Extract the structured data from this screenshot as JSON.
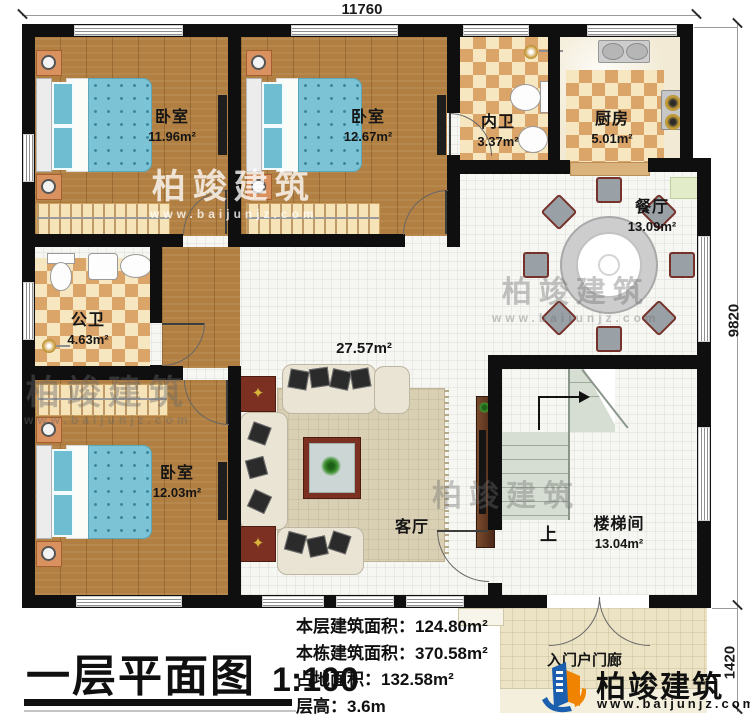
{
  "dimensions": {
    "top": "11760",
    "right_main": "9820",
    "right_porch": "1420"
  },
  "rooms": {
    "bedroom1": {
      "label": "卧室",
      "area": "11.96m²"
    },
    "bedroom2": {
      "label": "卧室",
      "area": "12.67m²"
    },
    "bedroom3": {
      "label": "卧室",
      "area": "12.03m²"
    },
    "inner_bath": {
      "label": "内卫",
      "area": "3.37m²"
    },
    "kitchen": {
      "label": "厨房",
      "area": "5.01m²"
    },
    "public_bath": {
      "label": "公卫",
      "area": "4.63m²"
    },
    "dining": {
      "label": "餐厅",
      "area": "13.09m²"
    },
    "living": {
      "label": "客厅",
      "area": "27.57m²"
    },
    "stairwell": {
      "label": "楼梯间",
      "area": "13.04m²",
      "up": "上"
    },
    "porch": {
      "label": "入门户门廊"
    }
  },
  "title_block": {
    "title": "一层平面图",
    "scale": "1:100"
  },
  "stats": {
    "floor_area": {
      "label": "本层建筑面积：",
      "value": "124.80m²"
    },
    "building_area": {
      "label": "本栋建筑面积：",
      "value": "370.58m²"
    },
    "footprint": {
      "label": "占地面积：",
      "value": "132.58m²"
    },
    "floor_height": {
      "label": "层高：",
      "value": "3.6m"
    }
  },
  "branding": {
    "name": "柏竣建筑",
    "website": "www.baijunjz.com"
  },
  "watermark": {
    "name": "柏竣建筑",
    "website": "www.baijunjz.com"
  },
  "colors": {
    "wall": "#0f0f0f",
    "wood_floor": "#b17f41",
    "tile_accent": "#dba469",
    "brand_blue": "#1b5fae",
    "brand_orange": "#f08300"
  }
}
